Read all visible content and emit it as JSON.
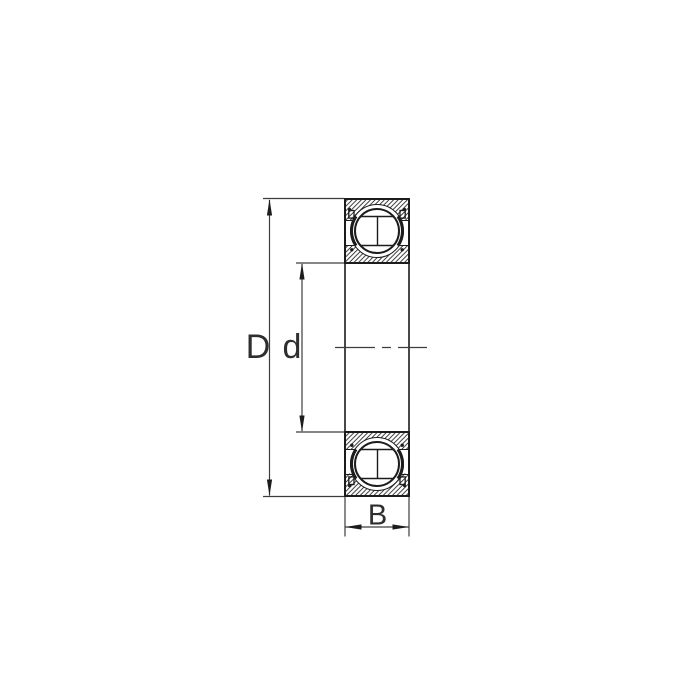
{
  "diagram": {
    "type": "deep-groove-ball-bearing-cross-section",
    "labels": {
      "outer_diameter": "D",
      "bore_diameter": "d",
      "width": "B"
    },
    "colors": {
      "background": "#ffffff",
      "part_outline": "#1c1c1c",
      "dimension_line": "#3d3d3d",
      "hatch": "#1c1c1c"
    }
  }
}
